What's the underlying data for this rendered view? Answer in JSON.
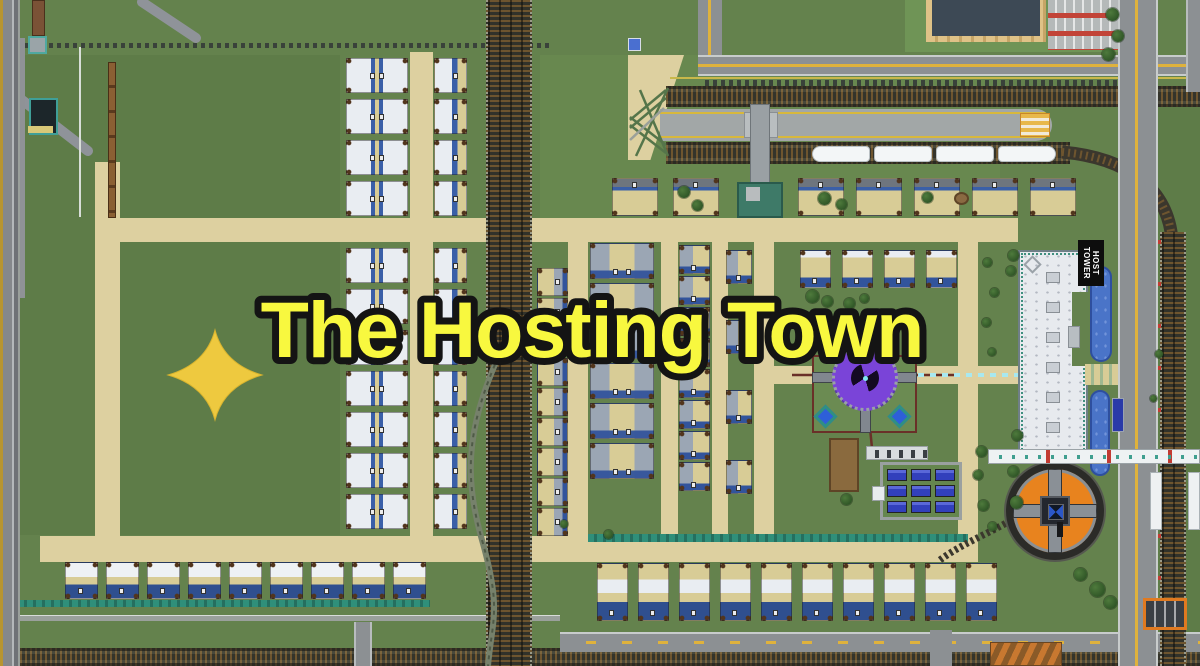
{
  "title": {
    "text": "The Hosting Town",
    "fill_color": "#f8f83f",
    "outline_color": "#141414"
  },
  "sign": {
    "line1": "HOST",
    "line2": "TOWER"
  },
  "palette": {
    "grass": "#64824d",
    "lawn": "#6f9456",
    "road_tan": "#ddd0a0",
    "road_gray": "#8c9093",
    "rail_tie": "#6e552f",
    "rail_dark": "#32322a",
    "house_roof_white": "#e9edf2",
    "house_roof_gray": "#9ba6b4",
    "house_tan": "#d8cc96",
    "house_blue": "#32549c",
    "beacon_purple": "#7a44d8",
    "turntable_orange": "#e8831e",
    "pool_blue": "#4a74c8",
    "solar_blue": "#3240bc",
    "marker_yellow": "#eec93f",
    "line_yellow": "#dfb23c",
    "teal_hedge": "#2f8f7a",
    "title_yellow": "#f8f83f"
  },
  "map": {
    "train_cars": 4,
    "solar_panels": 9,
    "host_skylights": 6,
    "house_rows": [
      {
        "style": "hpair",
        "x": 346,
        "y": 58,
        "w": 62,
        "h": 35,
        "count": 4,
        "dx": 0,
        "dy": 41
      },
      {
        "style": "hpair",
        "x": 346,
        "y": 248,
        "w": 62,
        "h": 35,
        "count": 7,
        "dx": 0,
        "dy": 41
      },
      {
        "style": "hsingle",
        "x": 434,
        "y": 58,
        "w": 33,
        "h": 35,
        "count": 4,
        "dx": 0,
        "dy": 41
      },
      {
        "style": "hsingle",
        "x": 434,
        "y": 248,
        "w": 33,
        "h": 35,
        "count": 7,
        "dx": 0,
        "dy": 41
      },
      {
        "style": "hsingle2r",
        "x": 537,
        "y": 268,
        "w": 31,
        "h": 28,
        "count": 9,
        "dx": 0,
        "dy": 30
      },
      {
        "style": "hpair2",
        "x": 590,
        "y": 243,
        "w": 64,
        "h": 36,
        "count": 6,
        "dx": 0,
        "dy": 40
      },
      {
        "style": "hsingle2",
        "x": 679,
        "y": 245,
        "w": 31,
        "h": 29,
        "count": 8,
        "dx": 0,
        "dy": 31
      },
      {
        "style": "hsingle2",
        "x": 726,
        "y": 250,
        "w": 26,
        "h": 34,
        "count": 4,
        "dx": 0,
        "dy": 70
      },
      {
        "style": "htop",
        "x": 612,
        "y": 178,
        "w": 46,
        "h": 38,
        "count": 2,
        "dx": 61,
        "dy": 0
      },
      {
        "style": "htop",
        "x": 798,
        "y": 178,
        "w": 46,
        "h": 38,
        "count": 5,
        "dx": 58,
        "dy": 0
      },
      {
        "style": "hbig",
        "x": 800,
        "y": 250,
        "w": 31,
        "h": 38,
        "count": 4,
        "dx": 42,
        "dy": 0
      },
      {
        "style": "hbot",
        "x": 597,
        "y": 563,
        "w": 31,
        "h": 58,
        "count": 10,
        "dx": 41,
        "dy": 0
      },
      {
        "style": "hbl",
        "x": 65,
        "y": 562,
        "w": 33,
        "h": 37,
        "count": 9,
        "dx": 41,
        "dy": 0
      }
    ],
    "trees": [
      [
        1106,
        8,
        13
      ],
      [
        1112,
        30,
        12
      ],
      [
        1102,
        48,
        13
      ],
      [
        1008,
        250,
        11
      ],
      [
        1006,
        266,
        10
      ],
      [
        1012,
        430,
        11
      ],
      [
        1008,
        466,
        11
      ],
      [
        1010,
        496,
        13
      ],
      [
        976,
        446,
        11
      ],
      [
        973,
        470,
        10
      ],
      [
        978,
        500,
        11
      ],
      [
        988,
        522,
        9
      ],
      [
        1074,
        568,
        13
      ],
      [
        1090,
        582,
        15
      ],
      [
        1104,
        596,
        13
      ],
      [
        818,
        192,
        13
      ],
      [
        836,
        199,
        11
      ],
      [
        922,
        192,
        11
      ],
      [
        806,
        290,
        13
      ],
      [
        822,
        296,
        11
      ],
      [
        844,
        298,
        11
      ],
      [
        860,
        294,
        9
      ],
      [
        983,
        258,
        9
      ],
      [
        990,
        288,
        9
      ],
      [
        982,
        318,
        9
      ],
      [
        988,
        348,
        8
      ],
      [
        841,
        494,
        11
      ],
      [
        678,
        186,
        12
      ],
      [
        692,
        200,
        11
      ],
      [
        604,
        530,
        9
      ],
      [
        560,
        520,
        8
      ],
      [
        1155,
        350,
        8
      ],
      [
        1150,
        395,
        7
      ]
    ]
  }
}
